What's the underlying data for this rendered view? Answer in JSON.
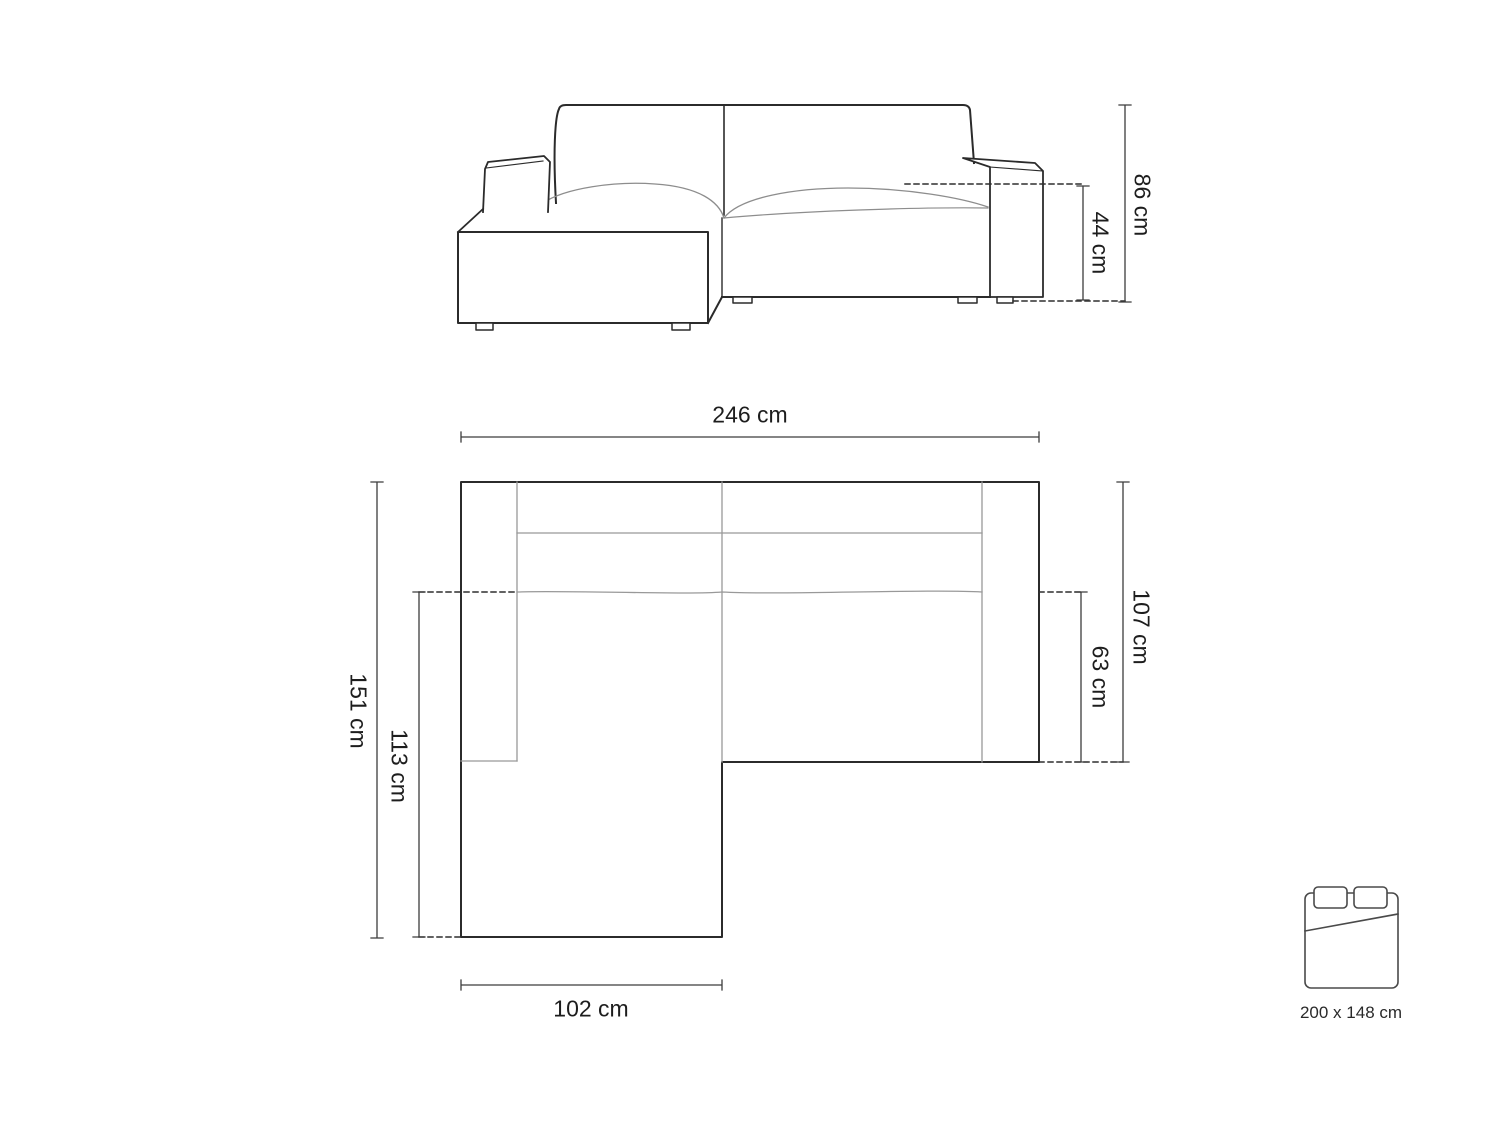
{
  "title": "Corner sofa technical drawing",
  "front_view": {
    "total_height": "86 cm",
    "seat_height": "44 cm"
  },
  "top_view": {
    "total_width": "246 cm",
    "total_depth": "151 cm",
    "chaise_inner_depth": "113 cm",
    "right_section_depth": "107 cm",
    "seat_depth": "63 cm",
    "chaise_width": "102 cm"
  },
  "sleeping_area": {
    "size": "200 x 148 cm"
  },
  "colors": {
    "outline": "#2b2b2b",
    "soft_line": "#979797",
    "dimension_line": "#3c3c3c",
    "text": "#1d1d1d",
    "background": "#ffffff"
  }
}
